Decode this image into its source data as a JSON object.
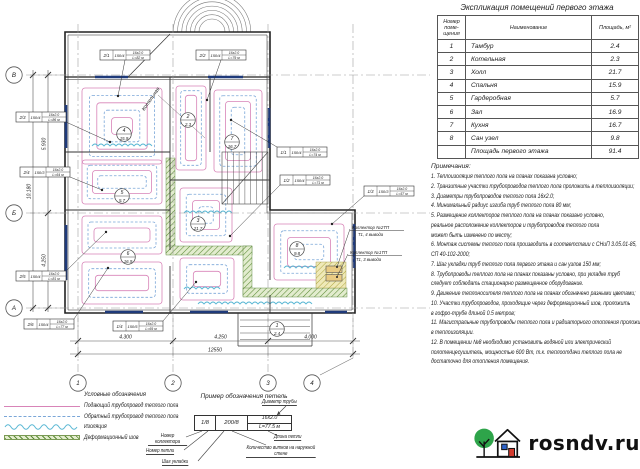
{
  "plan": {
    "axis_letters": [
      "В",
      "Б",
      "А"
    ],
    "axis_numbers": [
      "1",
      "2",
      "3",
      "4"
    ],
    "boiler_room_label": "Котельная",
    "dims_bottom": [
      "4.300",
      "4.250",
      "4.000"
    ],
    "dim_total_bottom": "12550",
    "dims_left": [
      "5.930",
      "4.250"
    ],
    "dim_total_left": "10.180",
    "collector_callouts": [
      {
        "line1": "Коллектор №2ТП",
        "line2": "Т1, 4 вывода"
      },
      {
        "line1": "Коллектор №1ТП",
        "line2": "Т1, 3 вывода"
      }
    ],
    "room_tags": [
      {
        "x": 124,
        "y": 134,
        "number": "4",
        "area": "15.9"
      },
      {
        "x": 122,
        "y": 196,
        "number": "5",
        "area": "5.7"
      },
      {
        "x": 128,
        "y": 257,
        "number": "6",
        "area": "16.9"
      },
      {
        "x": 232,
        "y": 142,
        "number": "7",
        "area": "16.7"
      },
      {
        "x": 198,
        "y": 224,
        "number": "3",
        "area": "21.7"
      },
      {
        "x": 297,
        "y": 249,
        "number": "8",
        "area": "9.8"
      },
      {
        "x": 277,
        "y": 329,
        "number": "1",
        "area": "2.4"
      },
      {
        "x": 188,
        "y": 120,
        "number": "2",
        "area": "2.3"
      }
    ],
    "pipe_callouts": [
      {
        "x": 100,
        "y": 50,
        "loop": "2/1",
        "step": "150/4",
        "pipe": "16х2.0",
        "len": "L=82 м",
        "tx": 118,
        "ty": 96
      },
      {
        "x": 196,
        "y": 50,
        "loop": "2/2",
        "step": "150/4",
        "pipe": "16х2.0",
        "len": "L=79 м",
        "tx": 207,
        "ty": 100
      },
      {
        "x": 16,
        "y": 112,
        "loop": "2/3",
        "step": "150/4",
        "pipe": "16х2.0",
        "len": "L=86 м",
        "tx": 110,
        "ty": 142
      },
      {
        "x": 20,
        "y": 167,
        "loop": "2/4",
        "step": "150/3",
        "pipe": "16х2.0",
        "len": "L=64 м",
        "tx": 102,
        "ty": 190
      },
      {
        "x": 16,
        "y": 271,
        "loop": "2/5",
        "step": "150/4",
        "pipe": "16х2.0",
        "len": "L=81 м",
        "tx": 106,
        "ty": 232
      },
      {
        "x": 24,
        "y": 319,
        "loop": "2/6",
        "step": "150/4",
        "pipe": "16х2.0",
        "len": "L=77 м",
        "tx": 108,
        "ty": 268
      },
      {
        "x": 113,
        "y": 321,
        "loop": "1/4",
        "step": "150/5",
        "pipe": "16х2.0",
        "len": "L=69 м",
        "tx": 196,
        "ty": 282
      },
      {
        "x": 277,
        "y": 147,
        "loop": "1/1",
        "step": "150/4",
        "pipe": "16х2.0",
        "len": "L=74 м",
        "tx": 231,
        "ty": 120
      },
      {
        "x": 280,
        "y": 175,
        "loop": "1/2",
        "step": "150/4",
        "pipe": "16х2.0",
        "len": "L=71 м",
        "tx": 230,
        "ty": 236
      },
      {
        "x": 364,
        "y": 186,
        "loop": "1/3",
        "step": "150/3",
        "pipe": "16х2.0",
        "len": "L=57 м",
        "tx": 332,
        "ty": 224
      }
    ]
  },
  "room_table": {
    "title": "Экспликация помещений первого этажа",
    "headers": [
      "Номер поме- щения",
      "Наименование",
      "Площадь, м²"
    ],
    "rows": [
      [
        "1",
        "Тамбур",
        "2.4"
      ],
      [
        "2",
        "Котельная",
        "2.3"
      ],
      [
        "3",
        "Холл",
        "21.7"
      ],
      [
        "4",
        "Спальня",
        "15.9"
      ],
      [
        "5",
        "Гардеробная",
        "5.7"
      ],
      [
        "6",
        "Зал",
        "16.9"
      ],
      [
        "7",
        "Кухня",
        "16.7"
      ],
      [
        "8",
        "Сан узел",
        "9.8"
      ]
    ],
    "total_row": [
      "",
      "Площадь первого этажа",
      "91.4"
    ]
  },
  "notes": {
    "title": "Примечания:",
    "lines": [
      "1. Теплоизоляция теплого пола на планах показана условно;",
      "2. Транзитные участки трубопроводов теплого пола проложить в теплоизоляции;",
      "3. Диаметры трубопроводов теплого пола 16х2.0;",
      "4. Минимальный радиус изгиба труб теплого пола 80 мм;",
      "5. Размещение коллекторов теплого пола на планах показано условно,",
      "реальное расположение коллекторов и трубопроводов теплого пола",
      "может быть изменено по месту;",
      "6. Монтаж системы теплого пола производить в соответствии с СНиП 3.05.01-85,",
      "СП 40-102-2000;",
      "7. Шаг укладки труб теплого пола первого этажа и сан узлов 150 мм;",
      "8. Трубопроводы теплого пола на планах показаны условно, при укладке труб",
      "следует соблюдать стационарно размещенное оборудование.",
      "9. Движение теплоносителя теплого пола на планах обозначено разными цветами;",
      "10. Участки трубопроводов, проходящие через деформационный шов, проложить",
      "в гофро-трубе длиной 0.5 метров;",
      "11. Магистральные трубопроводы теплого пола и радиаторного отопления проложить",
      "в теплоизоляции.",
      "12. В помещении №8 необходимо установить водяной или электрический",
      "полотенцесушитель, мощностью 600 Вт, т.к. теплоотдачи теплого пола не",
      "достаточно для отопления помещения."
    ]
  },
  "legend": {
    "title": "Условные обозначения",
    "items": [
      {
        "type": "supply",
        "label": "Подающий трубопровод теплого пола"
      },
      {
        "type": "return",
        "label": "Обратный трубопровод теплого пола"
      },
      {
        "type": "insulation",
        "label": "Изоляция"
      },
      {
        "type": "joint",
        "label": "Деформационный шов"
      }
    ]
  },
  "loop_example": {
    "title": "Пример обозначения петель",
    "cell_loop": "1/8",
    "cell_step": "200/8",
    "cell_pipe": "16х2.0",
    "cell_len": "L=77.5 м",
    "label_diameter": "Диаметр трубы",
    "label_collector": "Номер коллектора",
    "label_loop": "Номер петли",
    "label_step": "Шаг укладки",
    "label_len": "Длина петли",
    "label_turns": "Количество витков на наружной стене"
  },
  "watermark": {
    "site": "rosndv.ru"
  },
  "colors": {
    "supply": "#d884b8",
    "return_pipe": "#7aa6d8",
    "insulation": "#5bb8d4",
    "joint": "#5a8a34",
    "window": "#1f3a7a",
    "logo_green": "#2ea44a",
    "logo_blue": "#2e63c9",
    "logo_red": "#d23b2e"
  }
}
